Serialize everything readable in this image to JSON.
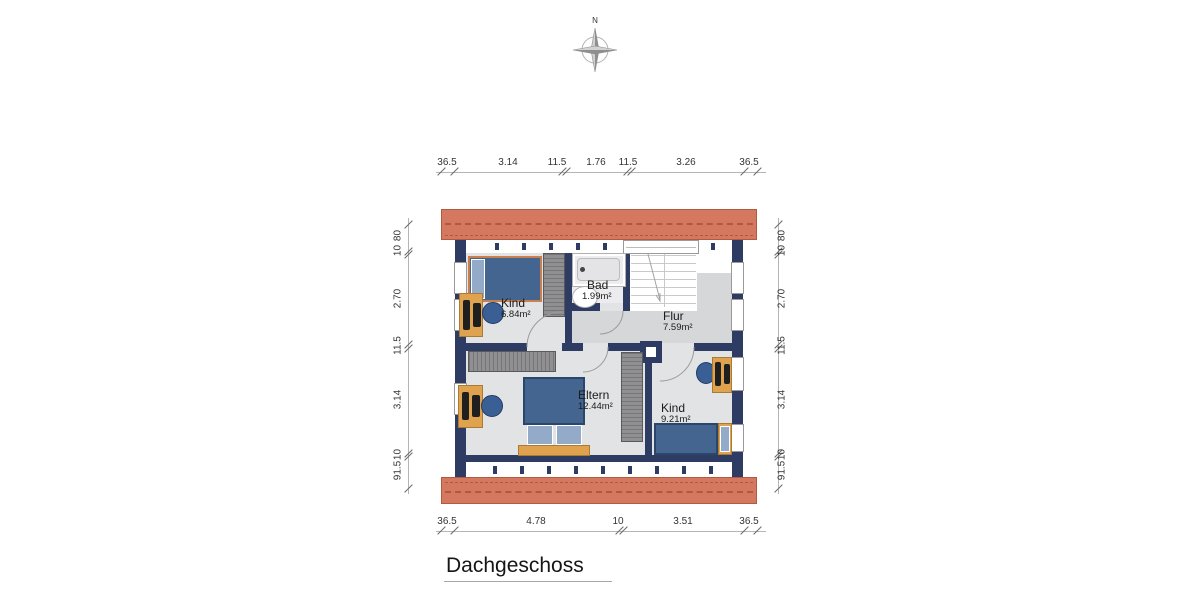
{
  "title": "Dachgeschoss",
  "compass": {
    "north_label": "N"
  },
  "rooms": {
    "kind_top": {
      "name": "Kind",
      "area": "6.84m²"
    },
    "bad": {
      "name": "Bad",
      "area": "1.99m²"
    },
    "flur": {
      "name": "Flur",
      "area": "7.59m²"
    },
    "eltern": {
      "name": "Eltern",
      "area": "12.44m²"
    },
    "kind_bottom": {
      "name": "Kind",
      "area": "9.21m²"
    }
  },
  "dimensions": {
    "top": [
      "36.5",
      "3.14",
      "11.5",
      "1.76",
      "11.5",
      "3.26",
      "36.5"
    ],
    "bottom": [
      "36.5",
      "4.78",
      "10",
      "3.51",
      "36.5"
    ],
    "left": [
      "80",
      "10",
      "2.70",
      "11.5",
      "3.14",
      "10",
      "91.5"
    ],
    "right": [
      "80",
      "10",
      "2.70",
      "11.5",
      "3.14",
      "10",
      "91.5"
    ]
  },
  "colors": {
    "roof": "#d4785f",
    "roof_line": "#b3593f",
    "wall": "#2e3c63",
    "room_floor": "#e2e3e5",
    "hall_floor": "#d6d7d9",
    "stair_floor": "#ffffff",
    "furniture_wood": "#dfa24e",
    "bed_blue": "#44658f",
    "pillow_blue": "#93abc9",
    "wardrobe_gray": "#909092",
    "dimension_text": "#333333"
  }
}
